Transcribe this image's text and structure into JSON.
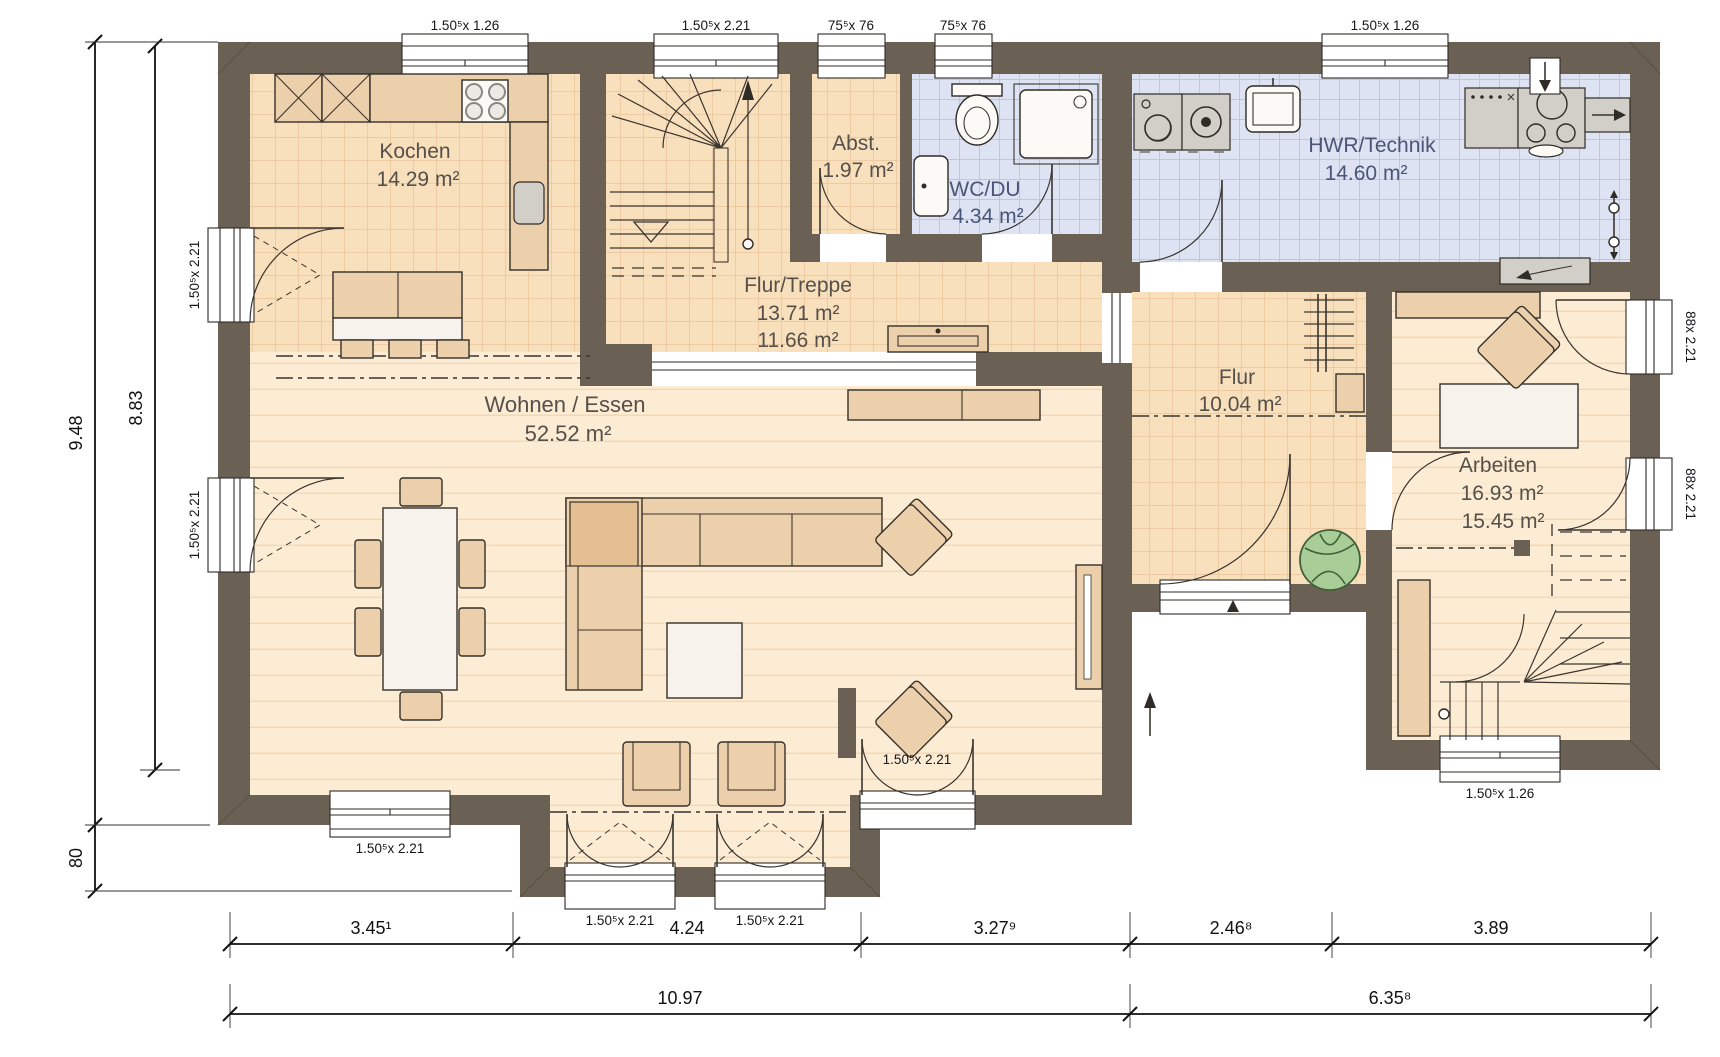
{
  "rooms": {
    "kochen": {
      "name": "Kochen",
      "area": "14.29 m²"
    },
    "abst": {
      "name": "Abst.",
      "area": "1.97 m²"
    },
    "wc": {
      "name": "WC/DU",
      "area": "4.34 m²"
    },
    "hwr": {
      "name": "HWR/Technik",
      "area": "14.60 m²"
    },
    "flur_treppe": {
      "name": "Flur/Treppe",
      "area_wohn": "13.71 m²",
      "area_nutz": "11.66 m²"
    },
    "wohnen": {
      "name": "Wohnen / Essen",
      "area": "52.52 m²"
    },
    "flur": {
      "name": "Flur",
      "area": "10.04 m²"
    },
    "arbeiten": {
      "name": "Arbeiten",
      "area_wohn": "16.93 m²",
      "area_nutz": "15.45 m²"
    }
  },
  "openings": {
    "top_kitchen_window": "1.50⁵x 1.26",
    "top_stair_window": "1.50⁵x 2.21",
    "top_abst_window": "75⁵x 76",
    "top_wc_window": "75⁵x 76",
    "top_hwr_window": "1.50⁵x 1.26",
    "left_kitchen_door": "1.50⁵x 2.21",
    "left_living_door": "1.50⁵x 2.21",
    "bottom_living_window": "1.50⁵x 2.21",
    "living_se_door": "1.50⁵x 2.21",
    "bay_door_left": "1.50⁵x 2.21",
    "bay_door_right": "1.50⁵x 2.21",
    "right_arbeiten_door_upper": "88x 2.21",
    "right_arbeiten_door_lower": "88x 2.21",
    "bottom_stair_window": "1.50⁵x 1.26"
  },
  "dimensions": {
    "vertical_total": "9.48",
    "vertical_main": "8.83",
    "vertical_bay": "80",
    "row1": [
      "3.45¹",
      "4.24",
      "3.27⁹",
      "2.46⁸",
      "3.89"
    ],
    "row2": [
      "10.97",
      "6.35⁸"
    ]
  },
  "colors": {
    "wall": "#6a6053",
    "tile_floor": "#f9e0bd",
    "tile_line": "#eccaa3",
    "plank_floor": "#fdecd4",
    "plank_line": "#f3d8b6",
    "blue_floor": "#dde3f2",
    "blue_line": "#bdc7e3",
    "furniture_tan": "#ecd0ab",
    "furniture_dark_tan": "#e3bf92",
    "furniture_white": "#f7f3ec",
    "appliance_gray": "#d2cfc8",
    "plant_green": "#a8cd97",
    "room_text": "#55504a",
    "room_text_blue": "#4b5578"
  }
}
